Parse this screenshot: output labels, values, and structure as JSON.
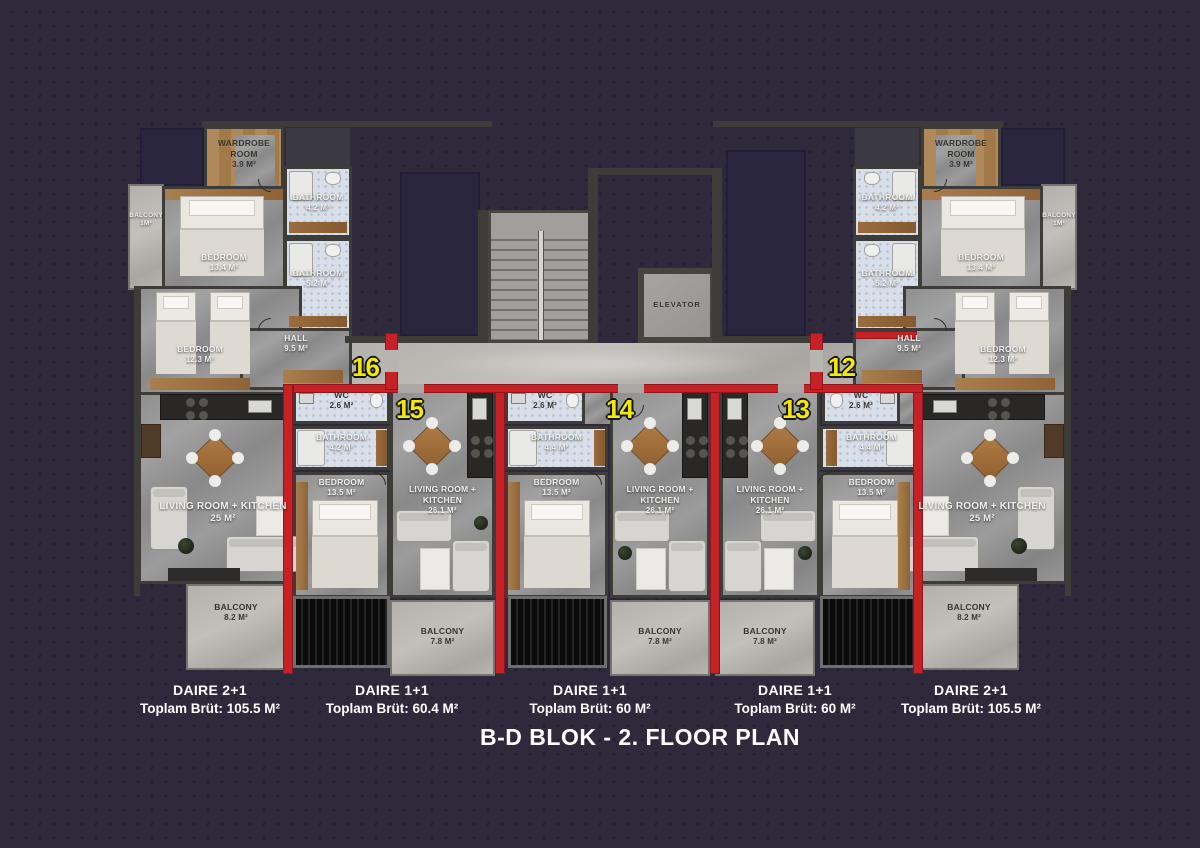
{
  "title": "B-D BLOK - 2. FLOOR PLAN",
  "core": {
    "elevator_label": "ELEVATOR"
  },
  "apt2p1": {
    "wardrobe": {
      "name": "WARDROBE ROOM",
      "area": "3.9 M²"
    },
    "bath_top": {
      "name": "BATHROOM",
      "area": "4.2 M²"
    },
    "bath_mid": {
      "name": "BATHROOM",
      "area": "5.2 M²"
    },
    "bedroom_main": {
      "name": "BEDROOM",
      "area": "13.4 M²"
    },
    "bedroom_second": {
      "name": "BEDROOM",
      "area": "12.3 M²"
    },
    "balcony_small": {
      "name": "BALCONY",
      "area": "1M²"
    },
    "hall": {
      "name": "HALL",
      "area": "9.5 M²"
    },
    "living": {
      "name": "LIVING ROOM + KITCHEN",
      "area": "25 M²"
    },
    "balcony": {
      "name": "BALCONY",
      "area": "8.2 M²"
    }
  },
  "units": {
    "u16": {
      "number": "16"
    },
    "u15": {
      "number": "15",
      "wc": {
        "name": "WC",
        "area": "2.6 M²"
      },
      "bath": {
        "name": "BATHROOM",
        "area": "4.2 M²"
      },
      "bedroom": {
        "name": "BEDROOM",
        "area": "13.5 M²"
      },
      "living": {
        "name": "LIVING ROOM + KITCHEN",
        "area": "26.1 M²"
      },
      "balcony": {
        "name": "BALCONY",
        "area": "7.8 M²"
      }
    },
    "u14": {
      "number": "14",
      "wc": {
        "name": "WC",
        "area": "2.6 M²"
      },
      "bath": {
        "name": "BATHROOM",
        "area": "4.4 M²"
      },
      "bedroom": {
        "name": "BEDROOM",
        "area": "13.5 M²"
      },
      "living": {
        "name": "LIVING ROOM + KITCHEN",
        "area": "26.1 M²"
      },
      "balcony": {
        "name": "BALCONY",
        "area": "7.8 M²"
      }
    },
    "u13": {
      "number": "13",
      "wc": {
        "name": "WC",
        "area": "2.6 M²"
      },
      "bath": {
        "name": "BATHROOM",
        "area": "4.4 M²"
      },
      "bedroom": {
        "name": "BEDROOM",
        "area": "13.5 M²"
      },
      "living": {
        "name": "LIVING ROOM + KITCHEN",
        "area": "26.1 M²"
      },
      "balcony": {
        "name": "BALCONY",
        "area": "7.8 M²"
      }
    },
    "u12": {
      "number": "12"
    }
  },
  "captions": [
    {
      "type": "DAIRE 2+1",
      "area": "Toplam Brüt: 105.5 M²"
    },
    {
      "type": "DAIRE 1+1",
      "area": "Toplam Brüt: 60.4 M²"
    },
    {
      "type": "DAIRE 1+1",
      "area": "Toplam Brüt: 60 M²"
    },
    {
      "type": "DAIRE 1+1",
      "area": "Toplam Brüt: 60 M²"
    },
    {
      "type": "DAIRE 2+1",
      "area": "Toplam Brüt: 105.5 M²"
    }
  ],
  "colors": {
    "background": "#2e2a3c",
    "wall": "#3d3c38",
    "red_accent": "#c62127",
    "unit_number_yellow": "#f3e70c",
    "floor_gray": "#969696",
    "corridor_gray": "#bdbbb7",
    "bath_floor": "#d9dfe8",
    "wood": "#a87e4e"
  }
}
